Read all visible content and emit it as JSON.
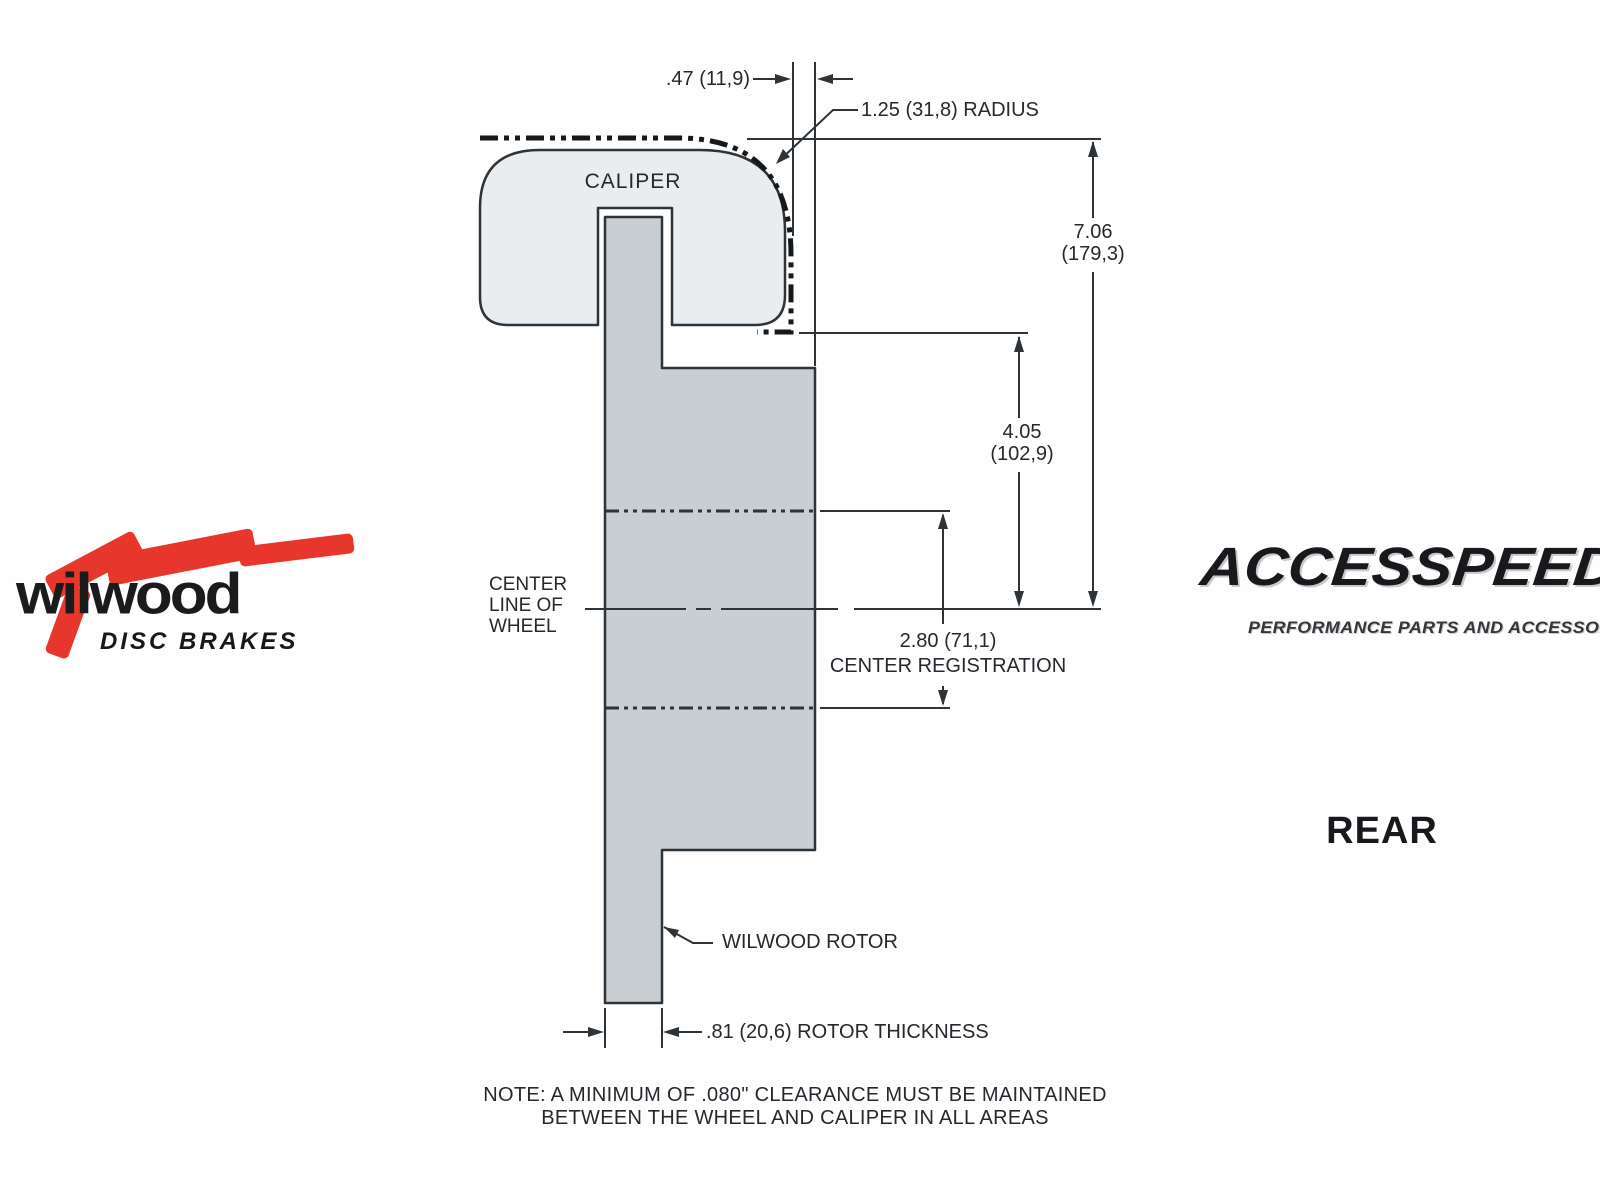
{
  "diagram": {
    "caliper_label": "CALIPER",
    "offset_dim": ".47 (11,9)",
    "radius_dim": "1.25 (31,8) RADIUS",
    "overall_height": {
      "inches": "7.06",
      "mm": "(179,3)"
    },
    "caliper_height": {
      "inches": "4.05",
      "mm": "(102,9)"
    },
    "centerline_label": [
      "CENTER",
      "LINE OF",
      "WHEEL"
    ],
    "registration": {
      "value": "2.80 (71,1)",
      "label": "CENTER REGISTRATION"
    },
    "rotor_label": "WILWOOD ROTOR",
    "thickness_dim": ".81 (20,6) ROTOR THICKNESS",
    "note": [
      "NOTE: A MINIMUM OF .080\" CLEARANCE MUST BE MAINTAINED",
      "BETWEEN THE WHEEL AND CALIPER IN ALL AREAS"
    ]
  },
  "branding": {
    "wilwood": {
      "name": "wilwood",
      "tagline": "DISC BRAKES"
    },
    "accesspeed": {
      "name": "ACCESSPEED",
      "tagline": "PERFORMANCE PARTS AND ACCESSORIES"
    },
    "view_label": "REAR"
  },
  "colors": {
    "caliper_fill": "#e9edf0",
    "rotor_fill": "#c9ced3",
    "line": "#2e3338",
    "wheel_line": "#16181a",
    "brand_red": "#e7362b"
  }
}
